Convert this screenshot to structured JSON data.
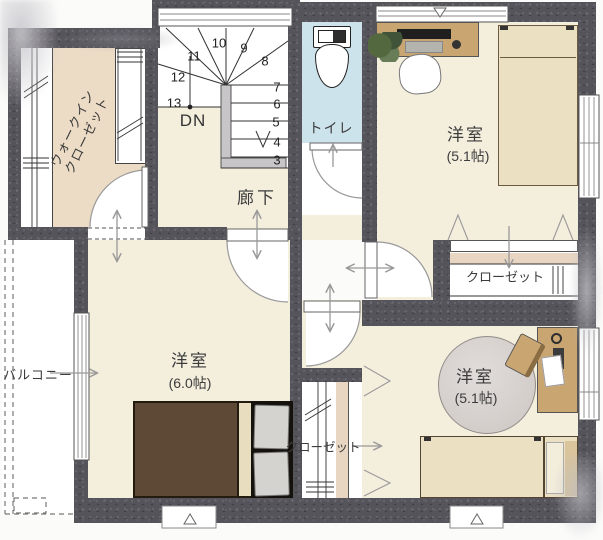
{
  "floorplan": {
    "rooms": {
      "walk_in_closet": {
        "label_line1": "ウォークイン",
        "label_line2": "クローゼット"
      },
      "hallway": {
        "label": "廊下"
      },
      "toilet": {
        "label": "トイレ"
      },
      "bedroom_ne": {
        "name": "洋室",
        "size": "(5.1帖)"
      },
      "bedroom_w": {
        "name": "洋室",
        "size": "(6.0帖)"
      },
      "bedroom_se": {
        "name": "洋室",
        "size": "(5.1帖)"
      },
      "closet_ne": {
        "label": "クローゼット"
      },
      "closet_se": {
        "label": "クローゼット"
      },
      "balcony": {
        "label": "バルコニー"
      }
    },
    "stairs": {
      "direction_label": "DN",
      "step_numbers": [
        "3",
        "4",
        "5",
        "6",
        "7",
        "8",
        "9",
        "10",
        "11",
        "12",
        "13"
      ]
    },
    "colors": {
      "wall": "#56545b",
      "floor": "#f4eedd",
      "walk_in_closet_floor": "#ecdcc6",
      "toilet_floor": "#cde3eb",
      "closet_shelf_strip": "#e8d6c2",
      "wood_furniture": "#c9a572",
      "bed_blanket": "#5d4936"
    }
  }
}
